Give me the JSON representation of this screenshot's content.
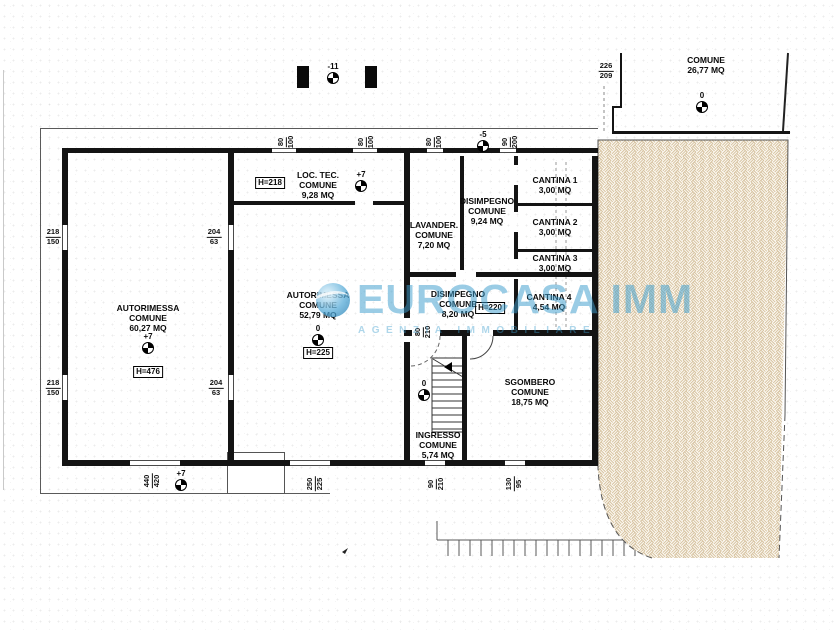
{
  "watermark": {
    "brand": "EUROCASA IMM",
    "subtitle": "AGENZIA IMMOBILIARE",
    "color": "#3e9ece"
  },
  "rooms": {
    "autorimessa_left": {
      "name": "AUTORIMESSA",
      "type": "COMUNE",
      "area": "60,27 MQ",
      "level": "+7",
      "height": "H=476"
    },
    "autorimessa_center": {
      "name": "AUTORIMESSA",
      "type": "COMUNE",
      "area": "52,79 MQ",
      "level": "0",
      "height": "H=225"
    },
    "loc_tec": {
      "name": "LOC. TEC.",
      "type": "COMUNE",
      "area": "9,28 MQ",
      "level": "+7",
      "height": "H=218"
    },
    "lavanderia": {
      "name": "LAVANDER.",
      "type": "COMUNE",
      "area": "7,20 MQ"
    },
    "disimpegno_upper": {
      "name": "DISIMPEGNO",
      "type": "COMUNE",
      "area": "9,24 MQ"
    },
    "cantina1": {
      "name": "CANTINA 1",
      "area": "3,00 MQ"
    },
    "cantina2": {
      "name": "CANTINA 2",
      "area": "3,00 MQ"
    },
    "cantina3": {
      "name": "CANTINA 3",
      "area": "3,00 MQ"
    },
    "cantina4": {
      "name": "CANTINA 4",
      "area": "4,54 MQ"
    },
    "disimpegno_central": {
      "name": "DISIMPEGNO",
      "type": "COMUNE",
      "area": "8,20 MQ",
      "height": "H=220"
    },
    "sgombero": {
      "name": "SGOMBERO",
      "type": "COMUNE",
      "area": "18,75 MQ"
    },
    "ingresso": {
      "name": "INGRESSO",
      "type": "COMUNE",
      "area": "5,74 MQ",
      "level": "0"
    },
    "courtyard": {
      "name": "COMUNE",
      "area": "26,77 MQ",
      "level": "0"
    }
  },
  "levels": {
    "pillars": "-11",
    "top_wall": "-5",
    "bottom_entrance": "+7"
  },
  "dimensions": {
    "left_upper": {
      "top": "218",
      "bottom": "150"
    },
    "left_lower": {
      "top": "218",
      "bottom": "150"
    },
    "mid_upper": {
      "top": "204",
      "bottom": "63"
    },
    "mid_lower": {
      "top": "204",
      "bottom": "63"
    },
    "top_win1": {
      "top": "80",
      "bottom": "100"
    },
    "top_win2": {
      "top": "80",
      "bottom": "100"
    },
    "top_win3": {
      "top": "80",
      "bottom": "100"
    },
    "top_door": {
      "top": "90",
      "bottom": "200"
    },
    "courtyard": {
      "top": "226",
      "bottom": "209"
    },
    "bottom_garage": {
      "top": "440",
      "bottom": "420"
    },
    "bottom_center": {
      "top": "250",
      "bottom": "225"
    },
    "bottom_ingresso": {
      "top": "90",
      "bottom": "210"
    },
    "bottom_sgombero": {
      "top": "130",
      "bottom": "95"
    },
    "disimpegno_door": {
      "top": "80",
      "bottom": "210"
    }
  }
}
